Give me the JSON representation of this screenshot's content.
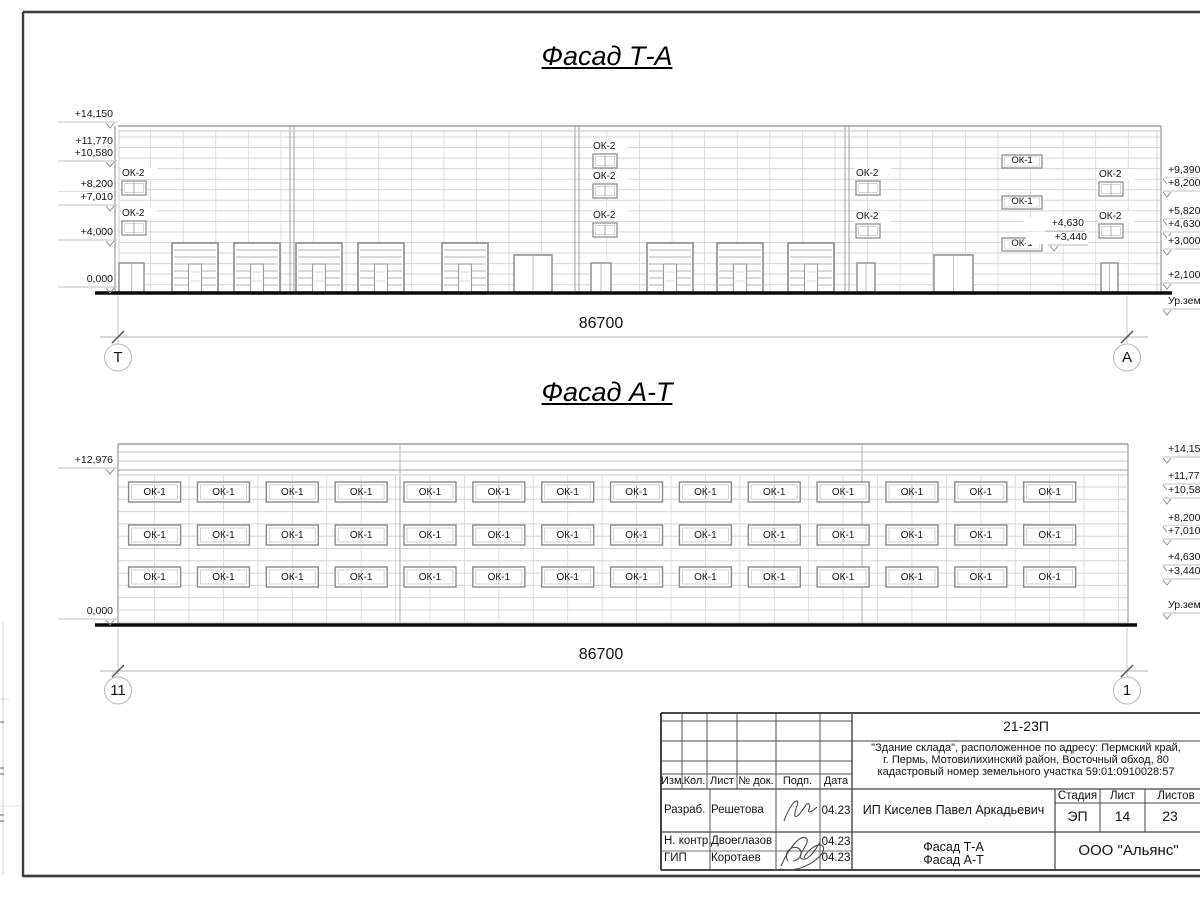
{
  "drawing": {
    "facade_ta": {
      "title": "Фасад Т-А",
      "dimension": "86700",
      "axis_left": "Т",
      "axis_right": "А",
      "elevation_marks_left": [
        "+14,150",
        "+11,770",
        "+10,580",
        "+8,200",
        "+7,010",
        "+4,000",
        "0,000"
      ],
      "elevation_marks_right": [
        "+9,390",
        "+8,200",
        "+5,820",
        "+4,630",
        "+3,000",
        "+2,100",
        "Ур.земли"
      ],
      "inline_elevation_marks": [
        "+4,630",
        "+3,440"
      ],
      "window_label_ok1": "ОК-1",
      "window_label_ok2": "ОК-2"
    },
    "facade_at": {
      "title": "Фасад А-Т",
      "dimension": "86700",
      "axis_left": "11",
      "axis_right": "1",
      "elevation_marks_left": [
        "+12,976",
        "0,000"
      ],
      "elevation_marks_right": [
        "+14,150",
        "+11,770",
        "+10,580",
        "+8,200",
        "+7,010",
        "+4,630",
        "+3,440",
        "Ур.земли"
      ],
      "window_label_ok1": "ОК-1"
    }
  },
  "title_block": {
    "document_code": "21-23П",
    "project_description_lines": [
      "\"Здание склада\", расположенное по адресу: Пермский край,",
      "г. Пермь, Мотовилихинский район, Восточный обход, 80",
      "кадастровый номер земельного участка 59:01:0910028:57"
    ],
    "client": "ИП Киселев Павел Аркадьевич",
    "drawing_titles": [
      "Фасад Т-А",
      "Фасад А-Т"
    ],
    "organization": "ООО \"Альянс\"",
    "revision_headers": [
      "Изм.",
      "Кол.",
      "Лист",
      "№ док.",
      "Подп.",
      "Дата"
    ],
    "stage_header": "Стадия",
    "sheet_header": "Лист",
    "sheets_total_header": "Листов",
    "stage": "ЭП",
    "sheet_number": "14",
    "sheets_total": "23",
    "signature_rows": [
      {
        "role": "Разраб.",
        "name": "Решетова",
        "date": "04.23"
      },
      {
        "role": "Н. контр.",
        "name": "Двоеглазов",
        "date": "04.23"
      },
      {
        "role": "ГИП",
        "name": "Коротаев",
        "date": "04.23"
      }
    ]
  }
}
